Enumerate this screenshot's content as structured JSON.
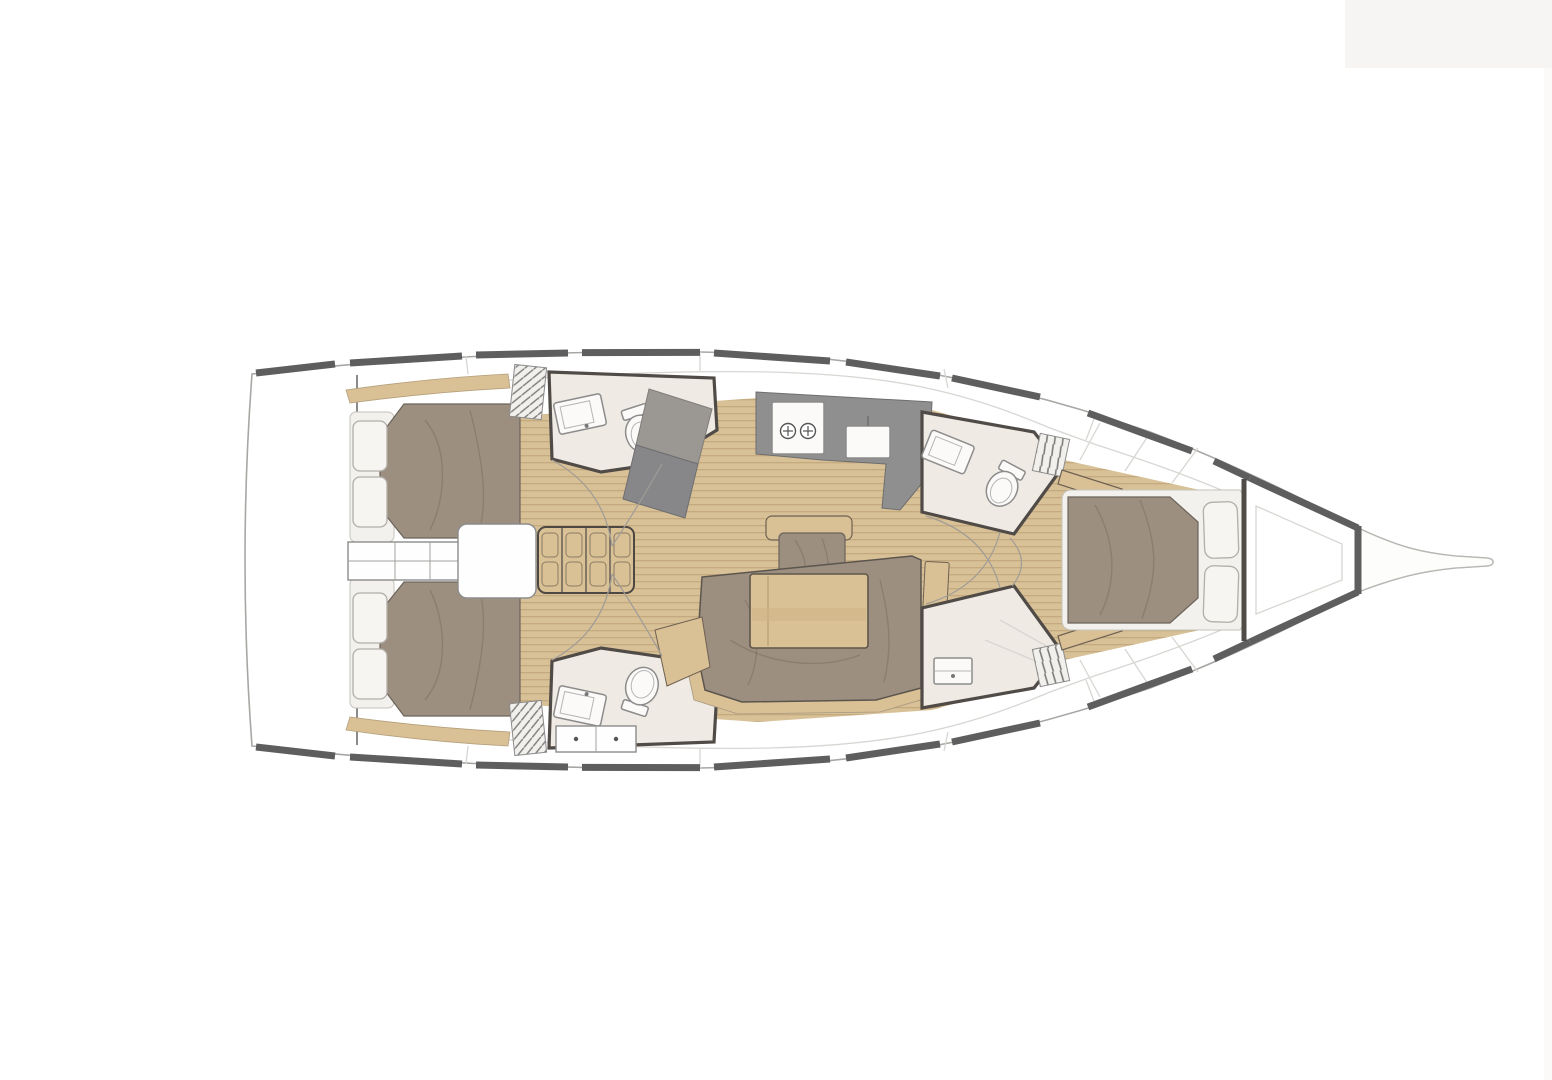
{
  "image": {
    "kind": "yacht-interior-floor-plan",
    "orientation": "bow-right",
    "has_text": false
  },
  "palette": {
    "background": "#ffffff",
    "topright_panel": "#f6f5f3",
    "right_edge_band": "#fbfaf8",
    "hull_rail": "#5e5e5e",
    "bulkhead_wall": "#504b46",
    "thin_outline": "#a9a7a4",
    "deck_seam": "#d8d6d2",
    "cabin_sole_wood": "#d9c197",
    "sole_plank_line": "#c4aa7e",
    "wood_trim": "#d9c095",
    "upholstery_taupe": "#9c8f80",
    "mattress_white": "#f3f1ed",
    "galley_counter_gray": "#8f8f8f",
    "nav_desk_gray": "#87878a",
    "head_floor_beige": "#efeae3",
    "fixture_white": "#fbfaf9"
  },
  "regions": [
    {
      "name": "stern-swim-platform"
    },
    {
      "name": "aft-cabin-port",
      "features": [
        "double-berth",
        "two-pillows",
        "hull-shelf"
      ]
    },
    {
      "name": "aft-cabin-starboard",
      "features": [
        "double-berth",
        "two-pillows",
        "hull-shelf"
      ]
    },
    {
      "name": "engine-compartment"
    },
    {
      "name": "companionway-steps"
    },
    {
      "name": "head-aft-port",
      "features": [
        "sink",
        "toilet"
      ]
    },
    {
      "name": "head-aft-starboard",
      "features": [
        "sink",
        "toilet",
        "drawer-unit"
      ]
    },
    {
      "name": "nav-station"
    },
    {
      "name": "galley",
      "features": [
        "two-burner-stove",
        "sink"
      ]
    },
    {
      "name": "salon",
      "features": [
        "centerline-bench",
        "dining-table",
        "u-shaped-settee",
        "side-seat"
      ]
    },
    {
      "name": "head-forward-port",
      "features": [
        "sink",
        "toilet",
        "louvered-locker"
      ]
    },
    {
      "name": "head-forward-starboard",
      "features": [
        "sink",
        "shower",
        "louvered-locker"
      ]
    },
    {
      "name": "forward-cabin",
      "features": [
        "island-berth",
        "two-pillows",
        "side-benches"
      ]
    },
    {
      "name": "bow-anchor-platform"
    }
  ]
}
